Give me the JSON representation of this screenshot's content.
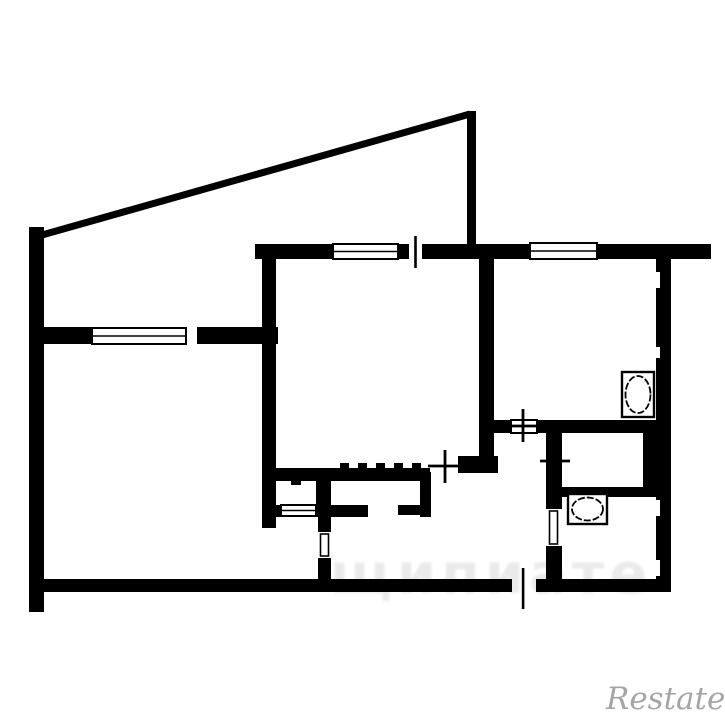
{
  "colors": {
    "background": "#ffffff",
    "wall": "#000000",
    "opening": "#ffffff",
    "watermark_gray": "#9c9c9c"
  },
  "watermarks": {
    "restate_label": "Restate",
    "faint_label": "щипиате"
  },
  "floorplan": {
    "canvas": {
      "width": 725,
      "height": 725
    },
    "diagonal_wall": {
      "name": "balcony-diagonal-wall",
      "x1": 42,
      "y1": 235,
      "x2": 470,
      "y2": 114,
      "thickness": 7
    },
    "walls": [
      {
        "name": "left-outer-wall",
        "x": 29,
        "y": 227,
        "w": 15,
        "h": 385
      },
      {
        "name": "balcony-parapet-wall",
        "x": 467,
        "y": 111,
        "w": 9,
        "h": 140
      },
      {
        "name": "top-main-wall",
        "x": 255,
        "y": 244,
        "w": 456,
        "h": 15
      },
      {
        "name": "right-outer-wall",
        "x": 656,
        "y": 259,
        "w": 15,
        "h": 333
      },
      {
        "name": "bottom-main-wall",
        "x": 29,
        "y": 579,
        "w": 642,
        "h": 13
      },
      {
        "name": "leftroom-top-wall",
        "x": 44,
        "y": 327,
        "w": 234,
        "h": 17
      },
      {
        "name": "bigroom-left-wall",
        "x": 262,
        "y": 259,
        "w": 14,
        "h": 269
      },
      {
        "name": "bigroom-bottom-wall-a",
        "x": 276,
        "y": 468,
        "w": 154,
        "h": 13
      },
      {
        "name": "bigroom-bottom-wall-b",
        "x": 458,
        "y": 456,
        "w": 40,
        "h": 17
      },
      {
        "name": "kitchen-left-wall",
        "x": 479,
        "y": 259,
        "w": 15,
        "h": 199
      },
      {
        "name": "kitchen-bottom-wall",
        "x": 494,
        "y": 420,
        "w": 162,
        "h": 13
      },
      {
        "name": "hall-bath-wall",
        "x": 546,
        "y": 433,
        "w": 16,
        "h": 146
      },
      {
        "name": "wc-bath-divider-wall",
        "x": 562,
        "y": 487,
        "w": 94,
        "h": 10
      },
      {
        "name": "wc-right-filler-wall",
        "x": 643,
        "y": 433,
        "w": 13,
        "h": 54
      },
      {
        "name": "closet-divider-wall",
        "x": 316,
        "y": 468,
        "w": 15,
        "h": 49
      },
      {
        "name": "closet1-bottom-stub",
        "x": 276,
        "y": 505,
        "w": 5,
        "h": 12
      },
      {
        "name": "closet2-bottom-left",
        "x": 331,
        "y": 505,
        "w": 37,
        "h": 12
      },
      {
        "name": "closet2-bottom-right",
        "x": 398,
        "y": 505,
        "w": 33,
        "h": 10
      },
      {
        "name": "closet2-right-wall",
        "x": 420,
        "y": 472,
        "w": 11,
        "h": 45
      },
      {
        "name": "leftroom-door-wall",
        "x": 318,
        "y": 517,
        "w": 13,
        "h": 62
      }
    ],
    "ticks": [
      {
        "name": "wardrobe-tick",
        "x": 340,
        "y": 463,
        "w": 9,
        "h": 5
      },
      {
        "name": "wardrobe-tick",
        "x": 358,
        "y": 463,
        "w": 9,
        "h": 5
      },
      {
        "name": "wardrobe-tick",
        "x": 376,
        "y": 463,
        "w": 9,
        "h": 5
      },
      {
        "name": "wardrobe-tick",
        "x": 394,
        "y": 463,
        "w": 9,
        "h": 5
      },
      {
        "name": "wardrobe-tick",
        "x": 412,
        "y": 463,
        "w": 9,
        "h": 5
      },
      {
        "name": "wardrobe-tick",
        "x": 291,
        "y": 481,
        "w": 10,
        "h": 4
      },
      {
        "name": "wardrobe-tick",
        "x": 320,
        "y": 481,
        "w": 11,
        "h": 4
      }
    ],
    "cuts": [
      {
        "name": "leftroom-balcony-opening",
        "x": 187,
        "y": 326,
        "w": 10,
        "h": 20
      },
      {
        "name": "bigroom-balcony-opening",
        "x": 409,
        "y": 243,
        "w": 13,
        "h": 17
      },
      {
        "name": "entrance-opening",
        "x": 512,
        "y": 579,
        "w": 24,
        "h": 13
      },
      {
        "name": "bath-door-opening",
        "x": 546,
        "y": 509,
        "w": 16,
        "h": 37
      },
      {
        "name": "leftroom-door-opening",
        "x": 318,
        "y": 532,
        "w": 13,
        "h": 26
      },
      {
        "name": "wall-notch",
        "x": 656,
        "y": 272,
        "w": 4,
        "h": 16
      },
      {
        "name": "wall-notch",
        "x": 656,
        "y": 347,
        "w": 4,
        "h": 11
      },
      {
        "name": "wall-notch",
        "x": 656,
        "y": 500,
        "w": 4,
        "h": 16
      },
      {
        "name": "wall-notch",
        "x": 656,
        "y": 560,
        "w": 4,
        "h": 16
      }
    ],
    "windows": [
      {
        "name": "leftroom-window",
        "x": 92,
        "y": 328,
        "w": 94,
        "h": 16,
        "mid": true
      },
      {
        "name": "bigroom-window",
        "x": 333,
        "y": 244,
        "w": 65,
        "h": 15,
        "mid": true
      },
      {
        "name": "kitchen-window",
        "x": 530,
        "y": 243,
        "w": 67,
        "h": 16,
        "mid": true
      },
      {
        "name": "kitchen-door-sym",
        "x": 511,
        "y": 420,
        "w": 26,
        "h": 13,
        "mid": false
      },
      {
        "name": "closet1-door-sym",
        "x": 281,
        "y": 505,
        "w": 35,
        "h": 11,
        "mid": true
      }
    ],
    "door_leaves": [
      {
        "name": "bath-door-leaf",
        "x": 549.5,
        "y": 511,
        "w": 8,
        "h": 33
      },
      {
        "name": "leftroom-door-leaf",
        "x": 320.5,
        "y": 534,
        "w": 8,
        "h": 22
      }
    ],
    "strokes": [
      {
        "name": "balcony-door-tick",
        "x": 414.2,
        "y": 236,
        "w": 2.6,
        "h": 32
      },
      {
        "name": "entrance-door-tick",
        "x": 521.8,
        "y": 568,
        "w": 2.6,
        "h": 41
      }
    ],
    "crosses": [
      {
        "name": "bigroom-door-cross",
        "cx": 445,
        "cy": 466,
        "hx1": 428,
        "hx2": 463,
        "vy1": 450,
        "vy2": 483
      },
      {
        "name": "kitchen-door-cross",
        "cx": 523,
        "cy": 426,
        "hx1": 507,
        "hx2": 539,
        "vy1": 409,
        "vy2": 442
      },
      {
        "name": "wc-door-cross",
        "cx": 554,
        "cy": 461,
        "hx1": 540,
        "hx2": 570,
        "vy1": 447,
        "vy2": 475
      }
    ],
    "fixtures": [
      {
        "name": "kitchen-stove",
        "rect": {
          "x": 622,
          "y": 372,
          "w": 32,
          "h": 45
        },
        "ellipse": {
          "cx": 638,
          "cy": 394.5,
          "rx": 12.5,
          "ry": 18.5
        }
      },
      {
        "name": "bath-sink",
        "rect": {
          "x": 568,
          "y": 494,
          "w": 39,
          "h": 30
        },
        "ellipse": {
          "cx": 587.5,
          "cy": 509,
          "rx": 15.5,
          "ry": 11.5
        }
      }
    ]
  }
}
